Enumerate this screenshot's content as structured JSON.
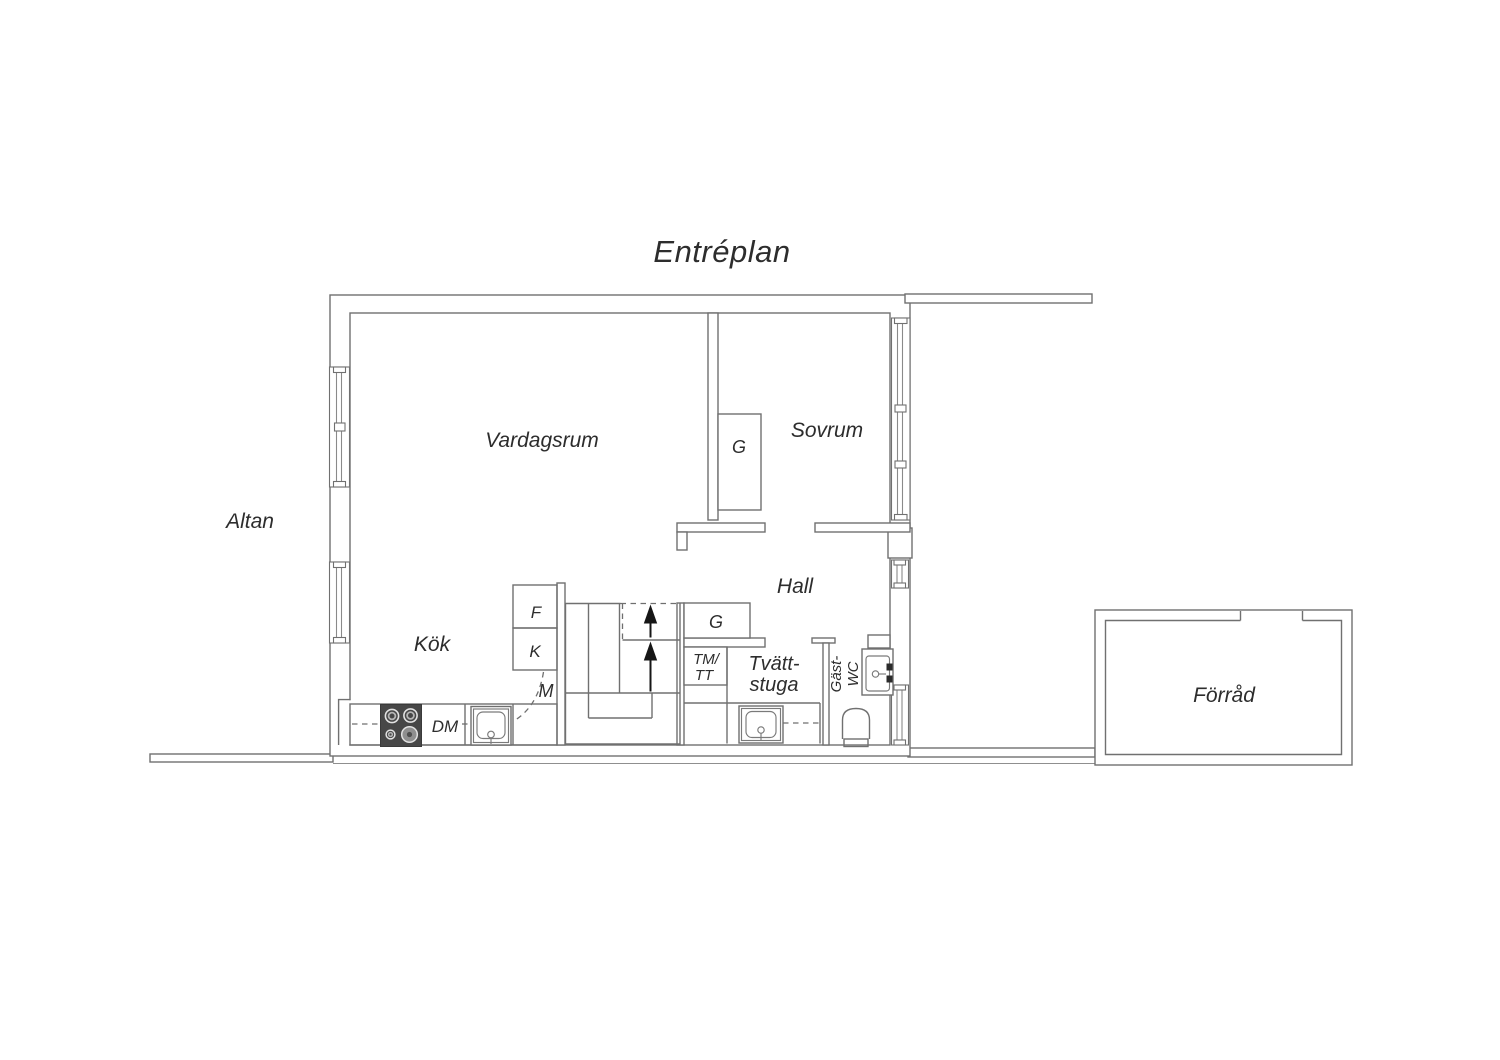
{
  "title": "Entréplan",
  "rooms": {
    "altan": "Altan",
    "vardagsrum": "Vardagsrum",
    "sovrum": "Sovrum",
    "kok": "Kök",
    "hall": "Hall",
    "tvattstuga": {
      "line1": "Tvätt-",
      "line2": "stuga"
    },
    "gast_wc": {
      "line1": "Gäst-",
      "line2": "WC"
    },
    "forrad": "Förråd"
  },
  "fixtures": {
    "wardrobe_sovrum": "G",
    "wardrobe_hall": "G",
    "fridge": "F",
    "freezer": "K",
    "micro": "M",
    "dishwasher": "DM",
    "washer_line1": "TM/",
    "washer_line2": "TT"
  },
  "colors": {
    "background": "#ffffff",
    "wall_line": "#707070",
    "light_line": "#8a8a8a",
    "text": "#2d2d2d",
    "appliance_dark": "#474747",
    "arrow": "#161616"
  }
}
